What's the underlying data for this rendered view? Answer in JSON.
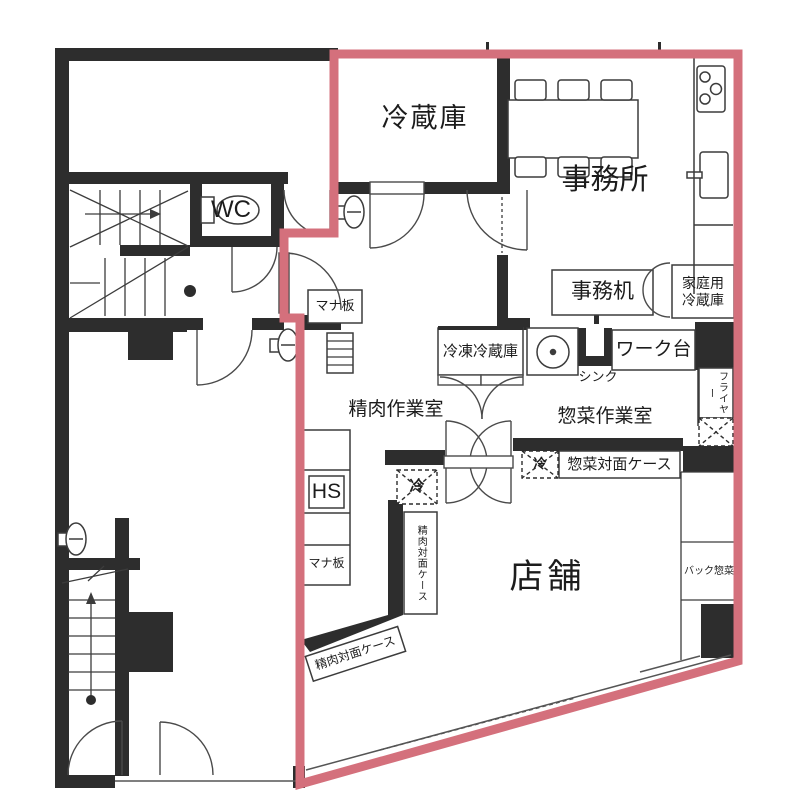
{
  "drawing": {
    "type": "architectural floor plan",
    "boundary_color": "#d4707c",
    "wall_color": "#2d2d2d"
  },
  "rooms": {
    "refrigerator": "冷蔵庫",
    "office": "事務所",
    "wc": "WC",
    "meat_workroom": "精肉作業室",
    "deli_workroom": "惣菜作業室",
    "store": "店舗"
  },
  "fixtures": {
    "office_desk": "事務机",
    "household_refrigerator": "家庭用\n冷蔵庫",
    "freezer_refrigerator": "冷凍冷蔵庫",
    "sink": "シンク",
    "work_table": "ワーク台",
    "fryer": "フライヤー",
    "deli_display_case": "惣菜対面ケース",
    "hand_sink": "HS",
    "cold_mark_1": "冷",
    "cold_mark_2": "冷",
    "cutting_board_upper": "マナ板",
    "cutting_board_lower": "マナ板",
    "meat_display_case_side": "精肉対面ケース",
    "meat_display_case_front": "精肉対面ケース",
    "back_deli": "バック惣菜"
  }
}
